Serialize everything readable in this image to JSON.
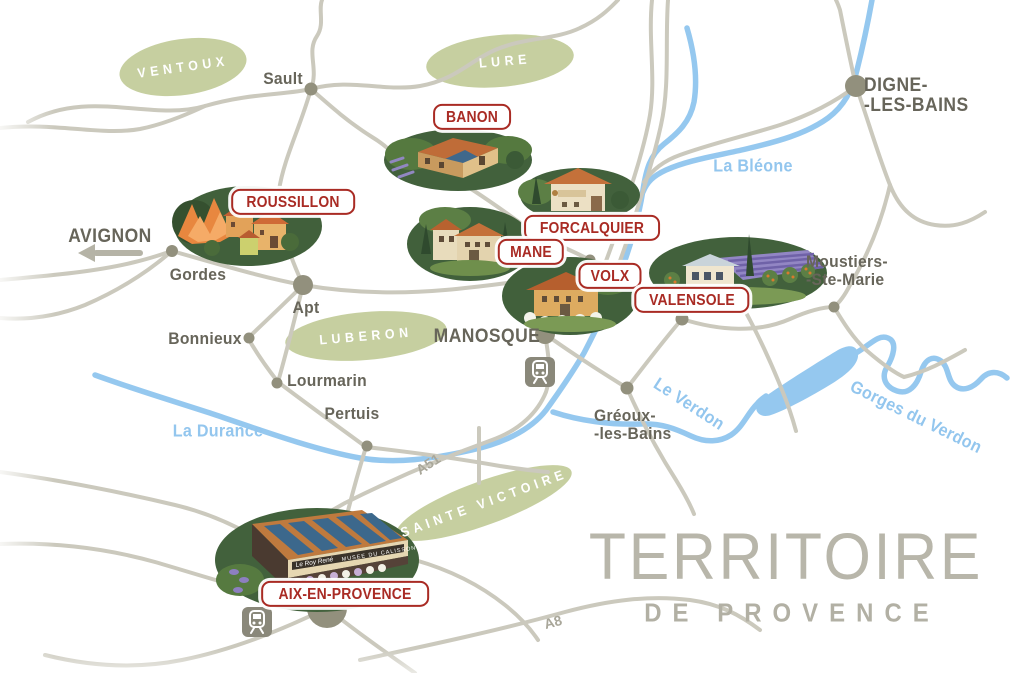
{
  "title": {
    "line1": "TERRITOIRE",
    "line2": "DE PROVENCE"
  },
  "regions": [
    {
      "id": "ventoux",
      "label": "VENTOUX"
    },
    {
      "id": "lure",
      "label": "LURE"
    },
    {
      "id": "luberon",
      "label": "LUBERON"
    },
    {
      "id": "sainte-victoire",
      "label": "SAINTE VICTOIRE"
    }
  ],
  "rivers": [
    {
      "id": "bleone",
      "label": "La Bléone"
    },
    {
      "id": "durance",
      "label": "La Durance"
    },
    {
      "id": "verdon",
      "label": "Le Verdon"
    },
    {
      "id": "gorges-du-verdon",
      "label": "Gorges du Verdon"
    }
  ],
  "motorways": [
    {
      "id": "a51",
      "label": "A51"
    },
    {
      "id": "a8",
      "label": "A8"
    }
  ],
  "direction": {
    "label": "AVIGNON"
  },
  "cities": [
    {
      "id": "sault",
      "name": "Sault"
    },
    {
      "id": "digne-les-bains",
      "line1": "DIGNE-",
      "line2": "-LES-BAINS"
    },
    {
      "id": "gordes",
      "name": "Gordes"
    },
    {
      "id": "apt",
      "name": "Apt"
    },
    {
      "id": "bonnieux",
      "name": "Bonnieux"
    },
    {
      "id": "lourmarin",
      "name": "Lourmarin"
    },
    {
      "id": "pertuis",
      "name": "Pertuis"
    },
    {
      "id": "manosque",
      "name": "MANOSQUE"
    },
    {
      "id": "greoux-les-bains",
      "line1": "Gréoux-",
      "line2": "-les-Bains"
    },
    {
      "id": "moustiers-ste-marie",
      "line1": "Moustiers-",
      "line2": "-Ste-Marie"
    }
  ],
  "sites": [
    {
      "id": "banon",
      "label": "BANON"
    },
    {
      "id": "roussillon",
      "label": "ROUSSILLON"
    },
    {
      "id": "forcalquier",
      "label": "FORCALQUIER"
    },
    {
      "id": "mane",
      "label": "MANE"
    },
    {
      "id": "volx",
      "label": "VOLX"
    },
    {
      "id": "valensole",
      "label": "VALENSOLE"
    },
    {
      "id": "aix-en-provence",
      "label": "AIX-EN-PROVENCE"
    }
  ],
  "factory_sign": {
    "left": "Le Roy René",
    "right": "MUSEE DU CALISSON"
  },
  "icons": [
    {
      "name": "train-station",
      "locations": [
        "MANOSQUE",
        "AIX-EN-PROVENCE"
      ]
    }
  ],
  "colors": {
    "region_green": "#c6cfa0",
    "river_blue": "#95c8ef",
    "road_gray": "#cbc9bd",
    "badge_red": "#a92b24",
    "city_text": "#67655a",
    "title_gray": "#b8b6aa"
  }
}
